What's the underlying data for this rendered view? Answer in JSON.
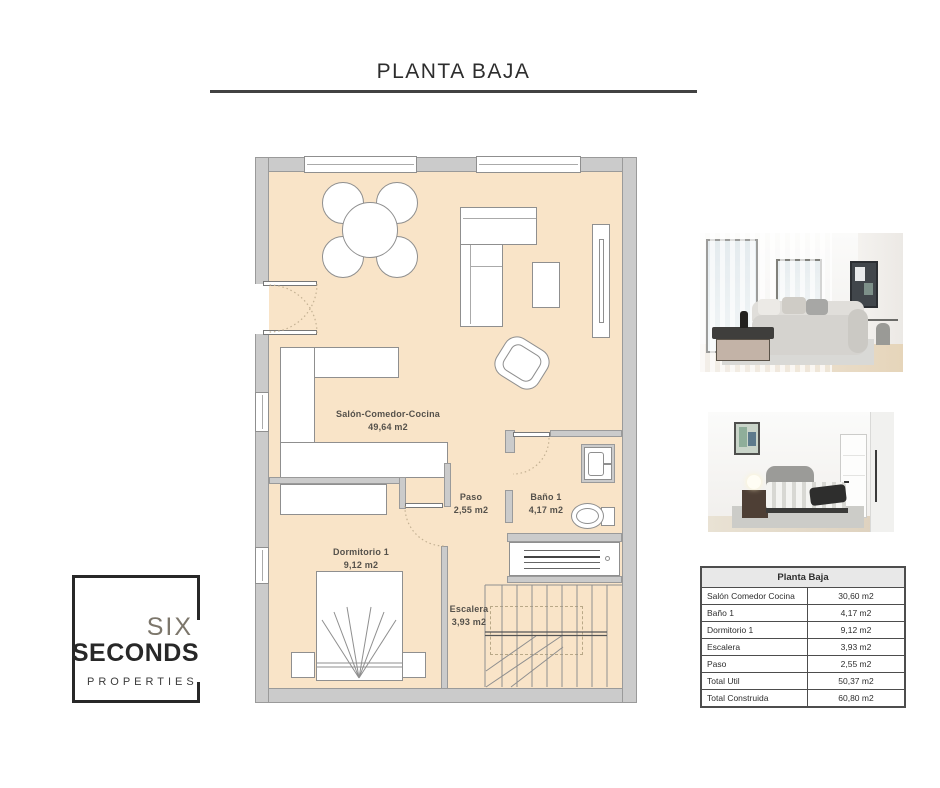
{
  "page": {
    "title": "PLANTA BAJA"
  },
  "floor_plan": {
    "rooms": [
      {
        "name": "Salón-Comedor-Cocina",
        "area": "49,64 m2"
      },
      {
        "name": "Paso",
        "area": "2,55 m2"
      },
      {
        "name": "Baño 1",
        "area": "4,17 m2"
      },
      {
        "name": "Dormitorio 1",
        "area": "9,12 m2"
      },
      {
        "name": "Escalera",
        "area": "3,93 m2"
      }
    ],
    "colors": {
      "floor": "#f9e4c8",
      "wall": "#cbcbcb",
      "wall_outline": "#9a9a9a",
      "furniture_outline": "#8f8f8f"
    }
  },
  "summary_table": {
    "title": "Planta Baja",
    "rows": [
      {
        "label": "Salón Comedor Cocina",
        "value": "30,60 m2"
      },
      {
        "label": "Baño 1",
        "value": "4,17 m2"
      },
      {
        "label": "Dormitorio 1",
        "value": "9,12 m2"
      },
      {
        "label": "Escalera",
        "value": "3,93 m2"
      },
      {
        "label": "Paso",
        "value": "2,55 m2"
      },
      {
        "label": "Total Util",
        "value": "50,37 m2"
      },
      {
        "label": "Total Construida",
        "value": "60,80 m2"
      }
    ]
  },
  "logo": {
    "word1": "SIX",
    "word2": "SECONDS",
    "word3": "PROPERTIES"
  },
  "photos": [
    {
      "name": "living-room-render"
    },
    {
      "name": "bedroom-render"
    }
  ]
}
